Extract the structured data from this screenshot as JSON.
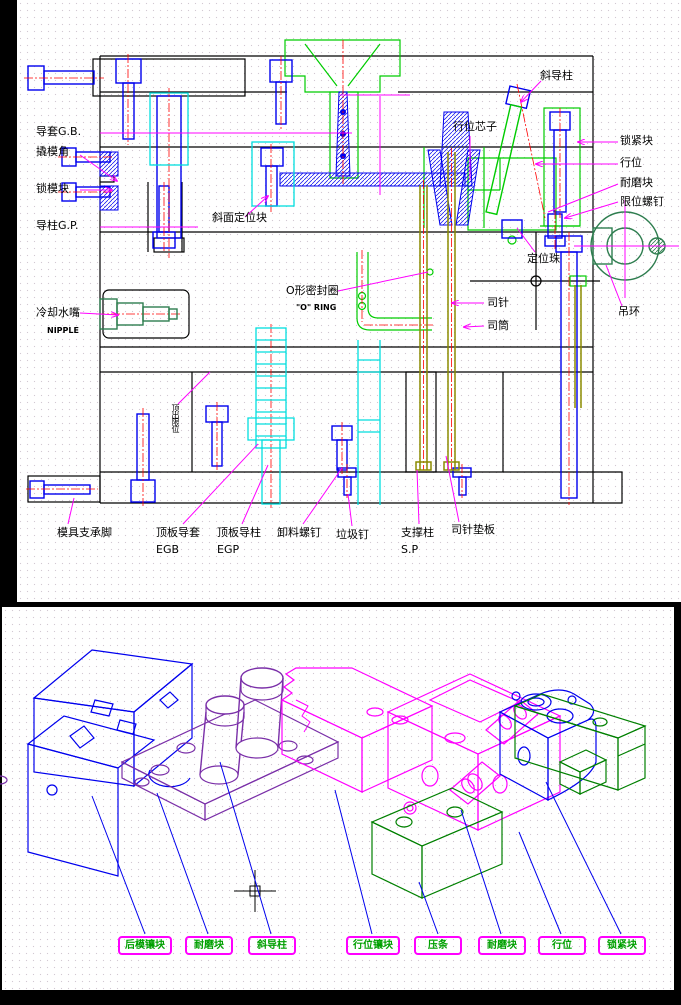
{
  "title": "注塑模具装配图 (injection mold assembly drawing)",
  "colors": {
    "outline": "#000000",
    "screws_blue": "#0000ee",
    "centerline_red": "#ff0000",
    "cavity_green": "#00cc00",
    "dark_green": "#2e7d4f",
    "spring_cyan": "#00dede",
    "pins_olive": "#8b8b00",
    "leader_magenta": "#ff00ff",
    "exploded_purple": "#7a2fa8",
    "tag_border": "#ff00ff",
    "tag_text": "#00a000"
  },
  "section_view": {
    "labels": {
      "guide_bushing": "导套G.B.",
      "pry_corner": "撬模角",
      "mold_lock_block": "锁模块",
      "guide_pillar": "导柱G.P.",
      "angled_locating_block": "斜面定位块",
      "cooling_nozzle": "冷却水嘴",
      "cooling_nozzle_en": "NIPPLE",
      "o_ring": "O形密封圈",
      "o_ring_en": "\"O\" RING",
      "ejector_limit": "顶出限位",
      "angle_pin": "斜导柱",
      "slide_core": "行位芯子",
      "locking_block": "锁紧块",
      "slide": "行位",
      "wear_block": "耐磨块",
      "limit_screw": "限位螺钉",
      "ball_catch": "定位珠",
      "eye_bolt": "吊环",
      "ejector_pin": "司针",
      "ejector_sleeve": "司筒",
      "mold_foot": "模具支承脚",
      "ejector_plate_bushing": "顶板导套",
      "ejector_plate_bushing_code": "EGB",
      "ejector_plate_pin": "顶板导柱",
      "ejector_plate_pin_code": "EGP",
      "stripper_screw": "卸料螺钉",
      "stop_pin": "垃圾钉",
      "support_pillar": "支撑柱",
      "support_pillar_code": "S.P",
      "ejector_pin_plate": "司针垫板"
    }
  },
  "exploded_view": {
    "tags": [
      {
        "label": "后模镶块"
      },
      {
        "label": "耐磨块"
      },
      {
        "label": "斜导柱"
      },
      {
        "label": "行位镶块"
      },
      {
        "label": "压条"
      },
      {
        "label": "耐磨块"
      },
      {
        "label": "行位"
      },
      {
        "label": "锁紧块"
      }
    ]
  }
}
